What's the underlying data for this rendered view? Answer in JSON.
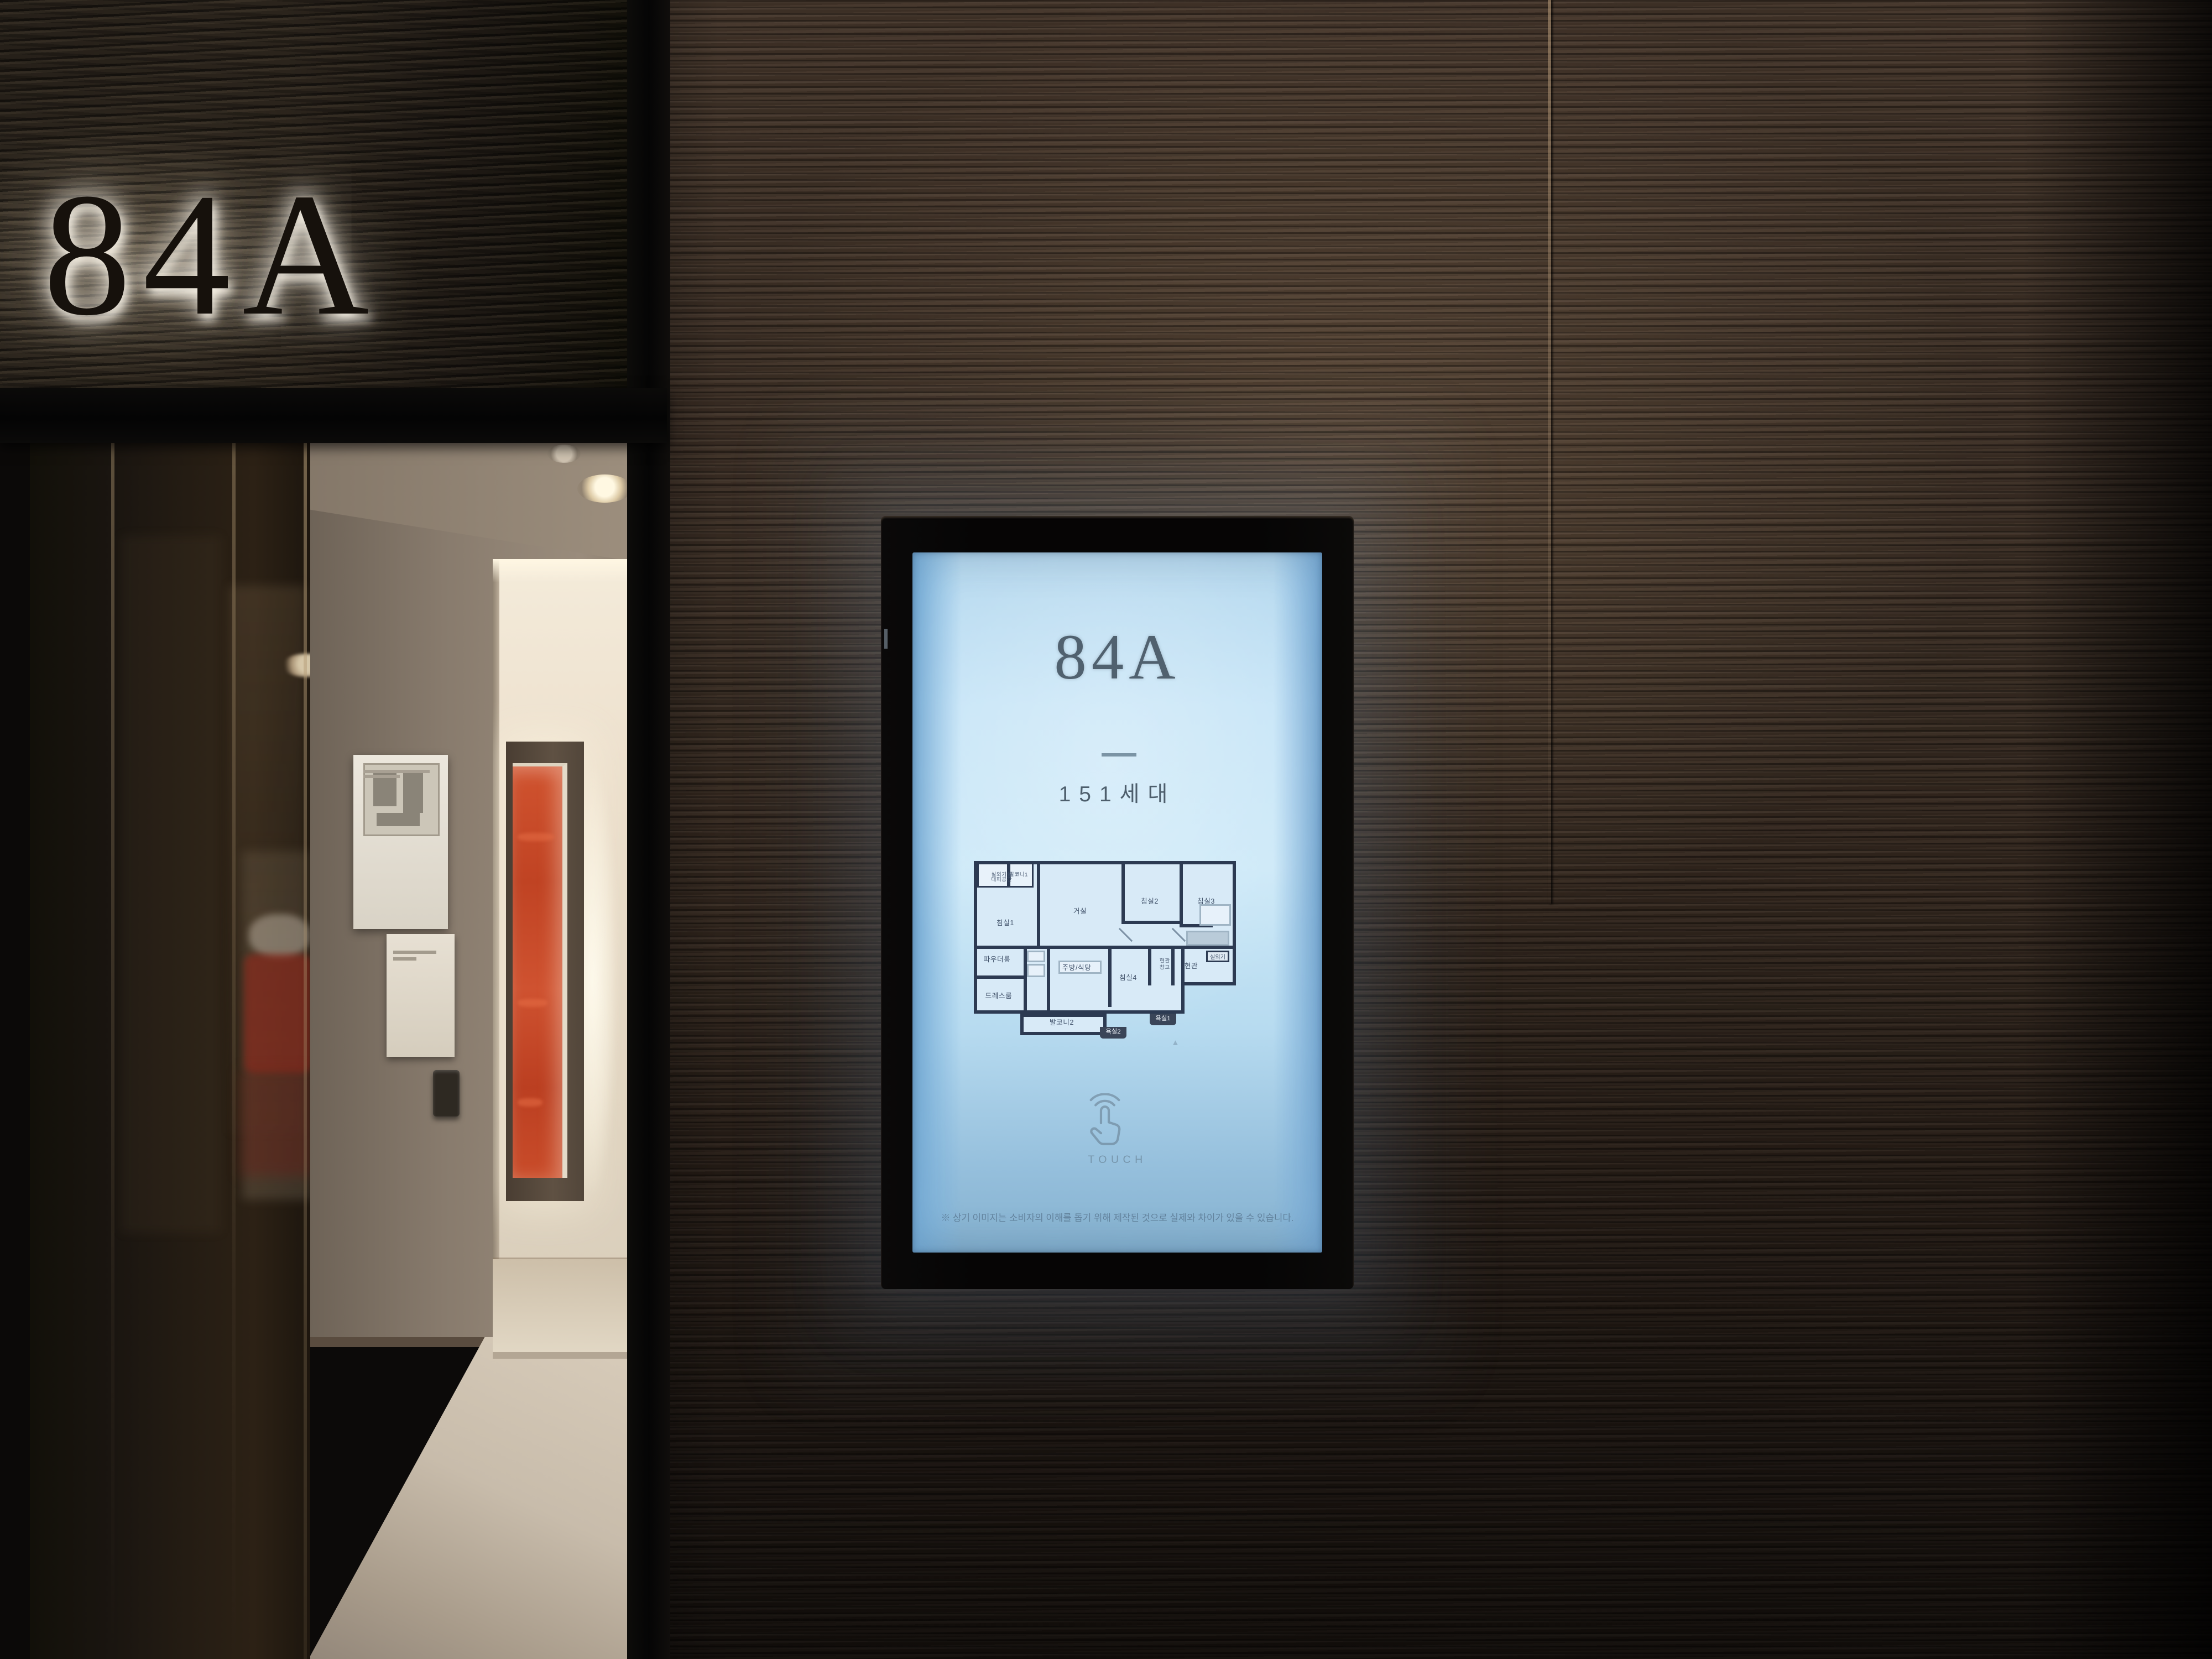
{
  "sign": {
    "label": "84A"
  },
  "kiosk": {
    "title": "84A",
    "household_count": "151세대",
    "touch_label": "TOUCH",
    "disclaimer": "※ 상기 이미지는 소비자의 이해를 돕기 위해 제작된 것으로 실제와 차이가 있을 수 있습니다.",
    "floorplan": {
      "outdoor_unit_room": "실외기실",
      "evacuation_space": "대피공간",
      "balcony1": "발코니1",
      "bedroom1": "침실1",
      "living_room": "거실",
      "bedroom2": "침실2",
      "bedroom3": "침실3",
      "powder_room": "파우더룸",
      "dress_room": "드레스룸",
      "kitchen_dining": "주방/식당",
      "bedroom4": "침실4",
      "entry_storage_line1": "현관",
      "entry_storage_line2": "창고",
      "entrance": "현관",
      "balcony2": "발코니2",
      "bath1": "욕실1",
      "bath2": "욕실2",
      "outdoor_unit": "실외기",
      "north_mark": "▲"
    },
    "colors": {
      "screen_blue": "#cde9f8",
      "screen_text": "#50616f",
      "plan_wall": "#2c3a52",
      "wall_brown": "#3a2d23",
      "artwork_orange": "#c64527",
      "sign_glow": "#fff7e6"
    }
  },
  "icons": {
    "touch": "touch-hand-icon",
    "north_arrow": "north-arrow-icon"
  }
}
